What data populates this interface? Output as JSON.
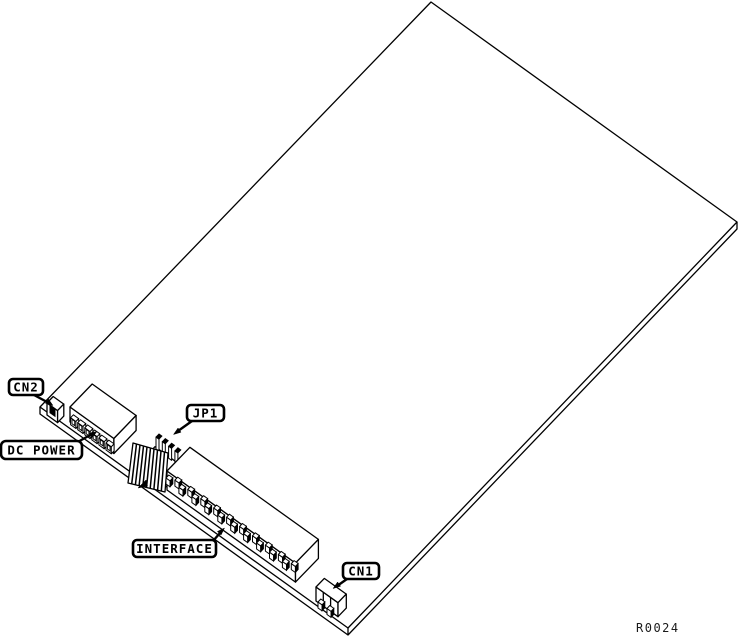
{
  "figure": {
    "background_color": "#ffffff",
    "line_color": "#000000",
    "reference_code": "R0024",
    "callouts": {
      "cn2": "CN2",
      "dc_power": "DC POWER",
      "jp1": "JP1",
      "interface": "INTERFACE",
      "cn1": "CN1"
    }
  }
}
